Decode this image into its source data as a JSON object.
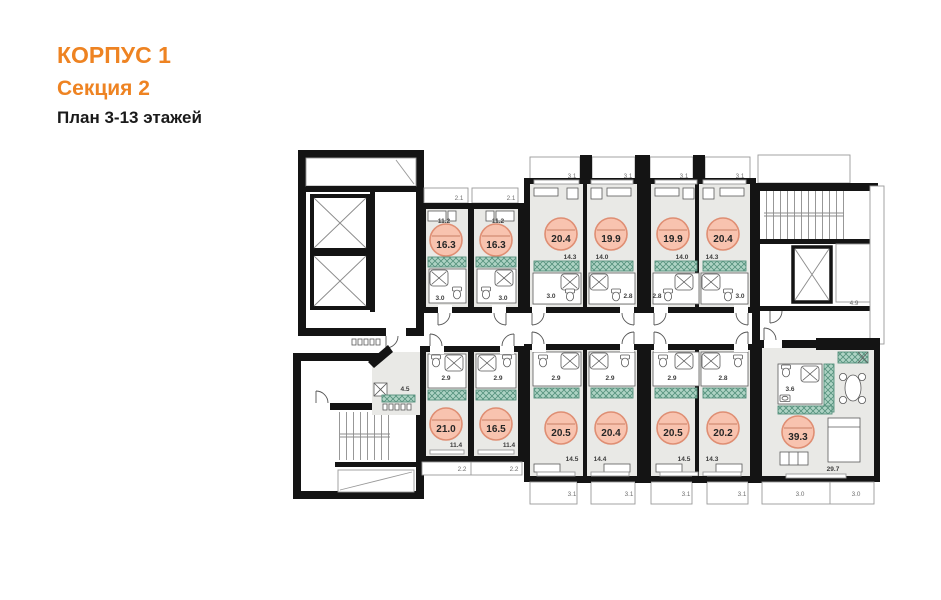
{
  "header": {
    "building": "КОРПУС 1",
    "section": "Секция 2",
    "plan": "План 3-13 этажей"
  },
  "colors": {
    "accent_orange": "#ee8322",
    "unit_circle_fill": "#f8c3af",
    "unit_circle_stroke": "#df8e73",
    "wardrobe_teal": "#aed3c4",
    "wall_black": "#141414",
    "room_gray": "#e9e9e6"
  },
  "upper": {
    "top_dims": [
      "2.1",
      "2.1"
    ],
    "studios": [
      {
        "total": "16.3",
        "room": "11.2",
        "bath": "3.0"
      },
      {
        "total": "16.3",
        "room": "11.2",
        "bath": "3.0"
      }
    ],
    "balconies": [
      "3.1",
      "3.1",
      "3.1",
      "3.1"
    ],
    "units": [
      {
        "total": "20.4",
        "room": "14.3",
        "bath": "3.0"
      },
      {
        "total": "19.9",
        "room": "14.0",
        "bath": "2.8"
      },
      {
        "total": "19.9",
        "room": "14.0",
        "bath": "2.8"
      },
      {
        "total": "20.4",
        "room": "14.3",
        "bath": "3.0"
      }
    ],
    "stair_core_dim": "4.9"
  },
  "lower": {
    "hall_dim": "4.5",
    "pair": [
      {
        "total": "21.0",
        "room": "11.4",
        "bath": "2.9",
        "bottom_dim": "2.2"
      },
      {
        "total": "16.5",
        "room": "11.4",
        "bath": "2.9",
        "bottom_dim": "2.2"
      }
    ],
    "units": [
      {
        "total": "20.5",
        "room": "14.5",
        "bath": "2.9",
        "balcony": "3.1"
      },
      {
        "total": "20.4",
        "room": "14.4",
        "bath": "2.9",
        "balcony": "3.1"
      },
      {
        "total": "20.5",
        "room": "14.5",
        "bath": "2.9",
        "balcony": "3.1"
      },
      {
        "total": "20.2",
        "room": "14.3",
        "bath": "2.8",
        "balcony": "3.1"
      }
    ],
    "apartment": {
      "total": "39.3",
      "room": "29.7",
      "bath": "3.6",
      "balconies": [
        "3.0",
        "3.0"
      ]
    }
  }
}
